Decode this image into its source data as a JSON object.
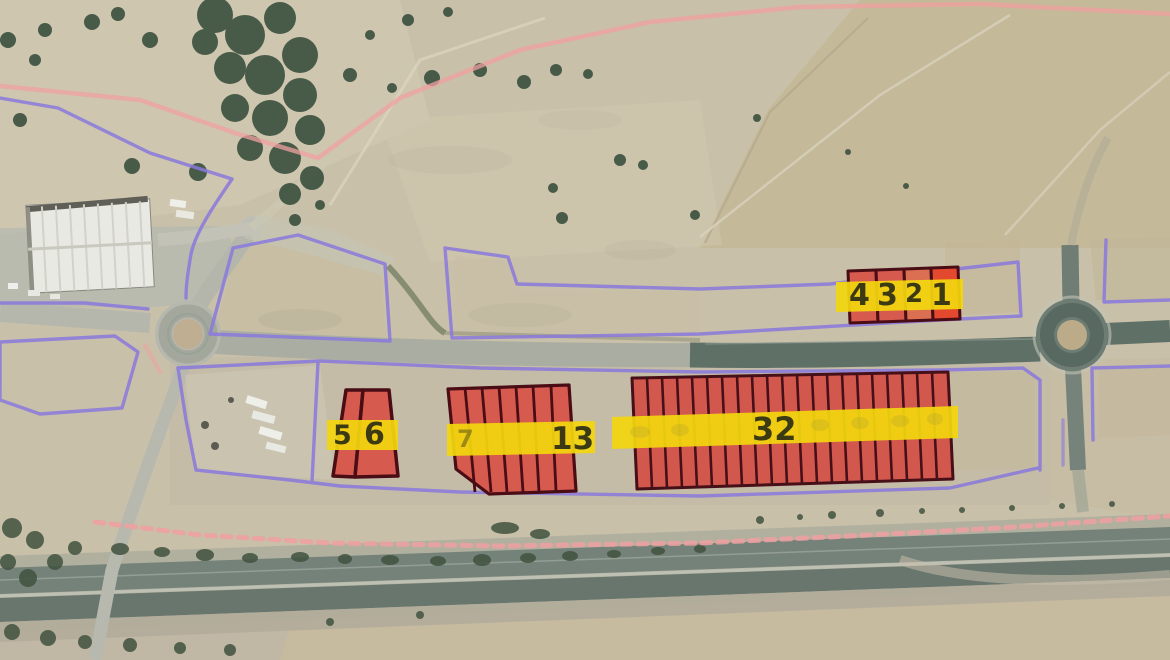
{
  "map": {
    "type": "annotated-aerial-photo",
    "subject": "industrial land plots for sale along a road between two roundabouts, railway corridor at bottom",
    "overlay": {
      "colors": {
        "parcel_fill": "#d65a4e",
        "parcel_fill_bright": "#e2492f",
        "parcel_border": "#4a0d15",
        "label_band": "#f2d60e",
        "label_text": "#3c3a12",
        "boundary_purple": "#8a79dd",
        "boundary_pink": "#f0a0a0"
      },
      "blocks": [
        {
          "name": "plots-1-4",
          "labels": [
            "4",
            "3",
            "2",
            "1"
          ]
        },
        {
          "name": "plots-5-6",
          "labels": [
            "5",
            "6"
          ]
        },
        {
          "name": "plots-7-13",
          "labels": [
            "7",
            "13"
          ]
        },
        {
          "name": "plots-14-32",
          "labels": [
            "32"
          ]
        }
      ]
    }
  }
}
